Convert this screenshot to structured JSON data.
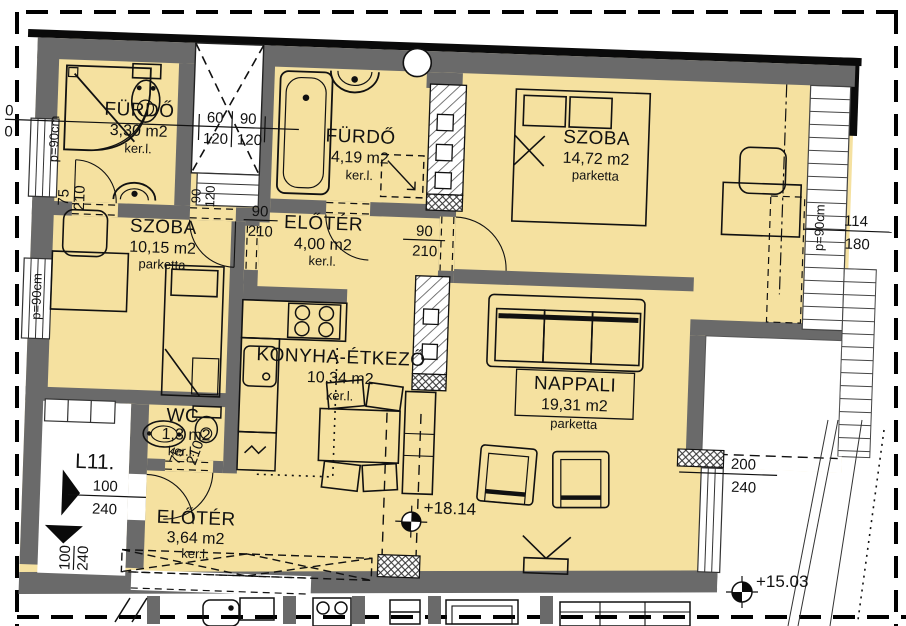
{
  "plan": {
    "unit": "L11.",
    "rooms": [
      {
        "id": "furdo1",
        "name": "FÜRDŐ",
        "area": "3,30 m2",
        "floor": "ker.l."
      },
      {
        "id": "furdo2",
        "name": "FÜRDŐ",
        "area": "4,19 m2",
        "floor": "ker.l."
      },
      {
        "id": "szoba1",
        "name": "SZOBA",
        "area": "14,72 m2",
        "floor": "parketta"
      },
      {
        "id": "szoba2",
        "name": "SZOBA",
        "area": "10,15 m2",
        "floor": "parketta"
      },
      {
        "id": "eloter1",
        "name": "ELŐTÉR",
        "area": "4,00 m2",
        "floor": "ker.l."
      },
      {
        "id": "konyha",
        "name": "KONYHA-ÉTKEZŐ",
        "area": "10,34 m2",
        "floor": "ker.l."
      },
      {
        "id": "nappali",
        "name": "NAPPALI",
        "area": "19,31 m2",
        "floor": "parketta"
      },
      {
        "id": "wc",
        "name": "WC",
        "area": "1,3 m2",
        "floor": "ker.l."
      },
      {
        "id": "eloter2",
        "name": "ELŐTÉR",
        "area": "3,64 m2",
        "floor": "ker.l."
      }
    ],
    "dims": {
      "shaft": {
        "a": "60",
        "b": "90",
        "c": "120",
        "d": "120"
      },
      "clipped_left": {
        "a": "0",
        "b": "0"
      },
      "door_a": {
        "w": "90",
        "h": "210"
      },
      "door_b": {
        "w": "90",
        "h": "210"
      },
      "door_c": {
        "w": "90",
        "h": "120"
      },
      "door_d": {
        "w": "75",
        "h": "210"
      },
      "door_e": {
        "w": "75",
        "h": "210"
      },
      "entry": {
        "w": "100",
        "h": "240"
      },
      "window_right": {
        "w": "114",
        "h": "180"
      },
      "terrace_door": {
        "w": "200",
        "h": "240"
      },
      "parapet": "p=90cm"
    },
    "elevations": {
      "living": "+18.14",
      "terrace": "+15.03"
    },
    "colors": {
      "room_fill": "#F5E1A0",
      "wall": "#6A6A6A",
      "line": "#111111"
    }
  }
}
